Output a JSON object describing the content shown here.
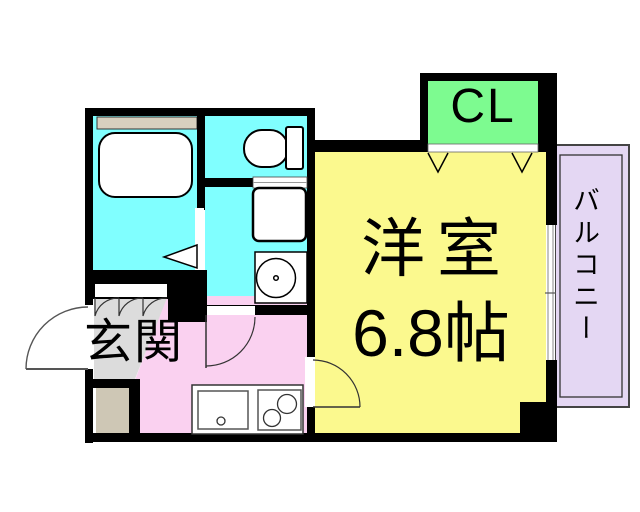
{
  "floorplan": {
    "labels": {
      "entrance": "玄関",
      "closet": "CL",
      "room_name": "洋室",
      "room_size": "6.8帖",
      "balcony": "バルコニー"
    },
    "colors": {
      "wall": "#000000",
      "wet_area": "#80FFFF",
      "closet": "#7DFB90",
      "western_room": "#FBF98E",
      "kitchen": "#FAD1F0",
      "balcony": "#E4D7F3",
      "balcony_border": "#444444",
      "entrance": "#DCDCDC",
      "bath_counter": "#D8D0BF",
      "porch": "#CEC7B5"
    }
  }
}
